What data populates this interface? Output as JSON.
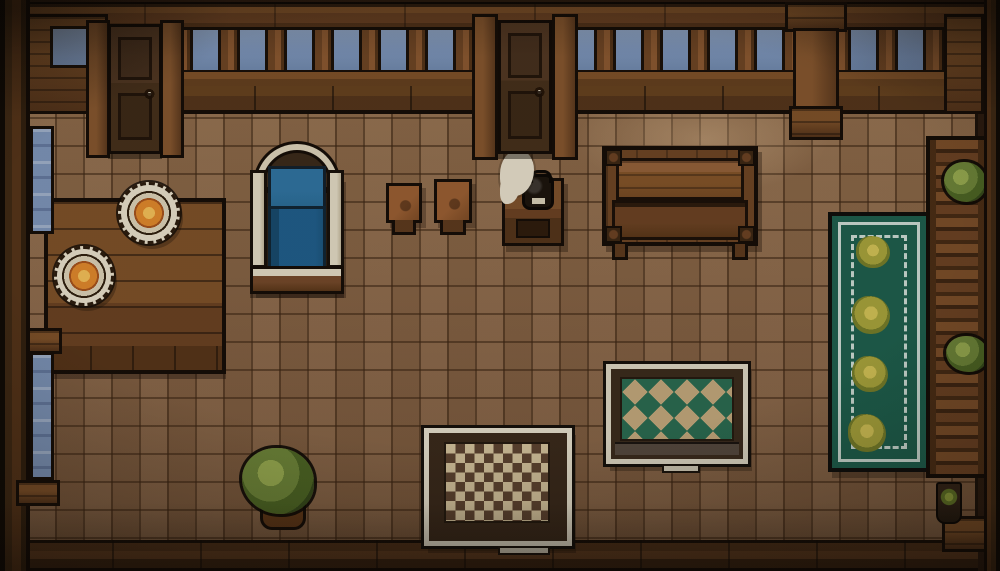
{
  "scene": {
    "description": "Top-down pixel-art tavern room: wooden walls with balustrade and sky gaps, two doors, side windows, bed with blue blanket, dining table with two plates of food, two stools, kettle stand with steam, long wooden table, teal flower runner rug, diamond-pattern rug, checkered rug, potted plants and a right-side wooden shelf",
    "objects": [
      {
        "id": "room-frame",
        "type": "room-bg",
        "x": 0,
        "y": 0,
        "w": 1000,
        "h": 571,
        "interactable": false
      },
      {
        "id": "floor",
        "type": "floor",
        "x": 24,
        "y": 86,
        "w": 954,
        "h": 460,
        "interactable": true
      },
      {
        "id": "floor-light-patch",
        "type": "floor-light-patch",
        "x": 548,
        "y": 90,
        "w": 310,
        "h": 118,
        "interactable": false
      },
      {
        "id": "bottom-floor-strip",
        "type": "bottom-floor-strip",
        "x": 24,
        "y": 540,
        "w": 954,
        "h": 31,
        "interactable": false
      },
      {
        "id": "rug-green",
        "type": "rug-green",
        "x": 828,
        "y": 212,
        "w": 102,
        "h": 260,
        "interactable": true
      },
      {
        "id": "rug-green-flower-1",
        "type": "flower",
        "x": 856,
        "y": 236,
        "w": 34,
        "h": 32,
        "interactable": false
      },
      {
        "id": "rug-green-flower-2",
        "type": "flower",
        "x": 852,
        "y": 296,
        "w": 38,
        "h": 38,
        "interactable": false
      },
      {
        "id": "rug-green-flower-3",
        "type": "flower",
        "x": 852,
        "y": 356,
        "w": 36,
        "h": 36,
        "interactable": false
      },
      {
        "id": "rug-green-flower-4",
        "type": "flower",
        "x": 848,
        "y": 414,
        "w": 38,
        "h": 38,
        "interactable": false
      },
      {
        "id": "rug-diamond",
        "type": "rug-frame-d",
        "x": 606,
        "y": 364,
        "w": 142,
        "h": 100,
        "interactable": true
      },
      {
        "id": "rug-diamond-field",
        "type": "rug-field-diamond",
        "x": 620,
        "y": 377,
        "w": 114,
        "h": 64,
        "interactable": false
      },
      {
        "id": "rug-diamond-tab",
        "type": "rug-tab",
        "x": 662,
        "y": 464,
        "w": 38,
        "h": 9,
        "interactable": false
      },
      {
        "id": "rug-checker",
        "type": "rug-frame-c",
        "x": 424,
        "y": 428,
        "w": 148,
        "h": 118,
        "interactable": true
      },
      {
        "id": "rug-checker-field",
        "type": "rug-field-checker",
        "x": 444,
        "y": 442,
        "w": 106,
        "h": 81,
        "interactable": false
      },
      {
        "id": "rug-checker-tab",
        "type": "rug-tab",
        "x": 498,
        "y": 546,
        "w": 52,
        "h": 9,
        "interactable": false
      },
      {
        "id": "dining-table",
        "type": "table-left",
        "x": 44,
        "y": 198,
        "w": 182,
        "h": 152,
        "interactable": true
      },
      {
        "id": "plate-large",
        "type": "plate",
        "x": 118,
        "y": 182,
        "w": 62,
        "h": 62,
        "interactable": true
      },
      {
        "id": "plate-small",
        "type": "plate",
        "x": 54,
        "y": 246,
        "w": 60,
        "h": 60,
        "interactable": true
      },
      {
        "id": "wall-bracket-left",
        "type": "wood-block",
        "x": 16,
        "y": 328,
        "w": 46,
        "h": 26,
        "interactable": false
      },
      {
        "id": "bed-frame",
        "type": "bed-body",
        "x": 252,
        "y": 176,
        "w": 90,
        "h": 116,
        "interactable": true
      },
      {
        "id": "bed-headboard-arch",
        "type": "bed-arch",
        "x": 256,
        "y": 144,
        "w": 82,
        "h": 46,
        "interactable": false
      },
      {
        "id": "bed-pillow",
        "type": "bed-mattress",
        "x": 268,
        "y": 166,
        "w": 58,
        "h": 44,
        "interactable": false
      },
      {
        "id": "bed-blanket",
        "type": "bed-blanket",
        "x": 268,
        "y": 206,
        "w": 58,
        "h": 66,
        "interactable": false
      },
      {
        "id": "bed-rail-left",
        "type": "bed-rail",
        "x": 250,
        "y": 170,
        "w": 17,
        "h": 98,
        "interactable": false
      },
      {
        "id": "bed-rail-right",
        "type": "bed-rail",
        "x": 327,
        "y": 170,
        "w": 17,
        "h": 98,
        "interactable": false
      },
      {
        "id": "bed-footboard",
        "type": "bed-foot",
        "x": 250,
        "y": 266,
        "w": 94,
        "h": 28,
        "interactable": false
      },
      {
        "id": "stool-1",
        "type": "stool",
        "x": 386,
        "y": 183,
        "w": 36,
        "h": 40,
        "interactable": true
      },
      {
        "id": "stool-2",
        "type": "stool",
        "x": 434,
        "y": 179,
        "w": 38,
        "h": 44,
        "interactable": true
      },
      {
        "id": "kettle-stand",
        "type": "stand",
        "x": 502,
        "y": 178,
        "w": 62,
        "h": 68,
        "interactable": true
      },
      {
        "id": "kettle",
        "type": "kettle",
        "x": 522,
        "y": 174,
        "w": 32,
        "h": 36,
        "interactable": true
      },
      {
        "id": "steam-puff",
        "type": "steam",
        "x": 500,
        "y": 150,
        "w": 34,
        "h": 46,
        "interactable": false
      },
      {
        "id": "long-table",
        "type": "lt-frame",
        "x": 602,
        "y": 146,
        "w": 156,
        "h": 100,
        "interactable": true
      },
      {
        "id": "long-table-top",
        "type": "lt-top",
        "x": 616,
        "y": 158,
        "w": 128,
        "h": 42,
        "interactable": false
      },
      {
        "id": "long-table-shelf",
        "type": "lt-shelf",
        "x": 612,
        "y": 200,
        "w": 136,
        "h": 40,
        "interactable": false
      },
      {
        "id": "long-table-corner-tl",
        "type": "lt-corner",
        "x": 605,
        "y": 149,
        "w": 17,
        "h": 17,
        "interactable": false
      },
      {
        "id": "long-table-corner-tr",
        "type": "lt-corner",
        "x": 738,
        "y": 149,
        "w": 17,
        "h": 17,
        "interactable": false
      },
      {
        "id": "long-table-corner-bl",
        "type": "lt-corner",
        "x": 605,
        "y": 226,
        "w": 17,
        "h": 17,
        "interactable": false
      },
      {
        "id": "long-table-corner-br",
        "type": "lt-corner",
        "x": 738,
        "y": 226,
        "w": 17,
        "h": 17,
        "interactable": false
      },
      {
        "id": "long-table-leg-left",
        "type": "lt-leg",
        "x": 612,
        "y": 244,
        "w": 16,
        "h": 16,
        "interactable": false
      },
      {
        "id": "long-table-leg-right",
        "type": "lt-leg",
        "x": 732,
        "y": 244,
        "w": 16,
        "h": 16,
        "interactable": false
      },
      {
        "id": "plant-shadow",
        "type": "shadow-blob",
        "x": 248,
        "y": 512,
        "w": 66,
        "h": 22,
        "interactable": false
      },
      {
        "id": "plant-pot",
        "type": "pot",
        "x": 260,
        "y": 494,
        "w": 46,
        "h": 36,
        "interactable": true
      },
      {
        "id": "plant-bush",
        "type": "bush",
        "x": 242,
        "y": 448,
        "w": 72,
        "h": 66,
        "interactable": true
      },
      {
        "id": "sky-band",
        "type": "sky",
        "x": 24,
        "y": 24,
        "w": 952,
        "h": 48,
        "interactable": false
      },
      {
        "id": "balustrade",
        "type": "balusters",
        "x": 24,
        "y": 22,
        "w": 952,
        "h": 54,
        "interactable": false
      },
      {
        "id": "top-beam",
        "type": "beam-top",
        "x": 14,
        "y": 2,
        "w": 972,
        "h": 28,
        "interactable": false
      },
      {
        "id": "balustrade-rail",
        "type": "beam-rail",
        "x": 20,
        "y": 70,
        "w": 960,
        "h": 18,
        "interactable": false
      },
      {
        "id": "wall-plank-row",
        "type": "wall-planks",
        "x": 20,
        "y": 86,
        "w": 960,
        "h": 28,
        "interactable": false
      },
      {
        "id": "wall-corner-left",
        "type": "wood-block",
        "x": 18,
        "y": 14,
        "w": 90,
        "h": 100,
        "interactable": false
      },
      {
        "id": "window-top-left",
        "type": "window-sky",
        "x": 50,
        "y": 26,
        "w": 42,
        "h": 42,
        "interactable": false
      },
      {
        "id": "wall-corner-right",
        "type": "wood-block",
        "x": 944,
        "y": 14,
        "w": 40,
        "h": 100,
        "interactable": false
      },
      {
        "id": "door-1-post-left",
        "type": "door-post",
        "x": 86,
        "y": 20,
        "w": 24,
        "h": 138,
        "interactable": false
      },
      {
        "id": "door-1-post-right",
        "type": "door-post",
        "x": 160,
        "y": 20,
        "w": 24,
        "h": 138,
        "interactable": false
      },
      {
        "id": "door-1",
        "type": "door",
        "x": 108,
        "y": 24,
        "w": 54,
        "h": 130,
        "interactable": true
      },
      {
        "id": "door-2-post-left",
        "type": "door-post",
        "x": 472,
        "y": 14,
        "w": 26,
        "h": 146,
        "interactable": false
      },
      {
        "id": "door-2-post-right",
        "type": "door-post",
        "x": 552,
        "y": 14,
        "w": 26,
        "h": 146,
        "interactable": false
      },
      {
        "id": "door-2",
        "type": "door",
        "x": 498,
        "y": 20,
        "w": 54,
        "h": 134,
        "interactable": true
      },
      {
        "id": "center-post-cap",
        "type": "wood-block",
        "x": 785,
        "y": 2,
        "w": 62,
        "h": 30,
        "interactable": false
      },
      {
        "id": "center-post",
        "type": "post",
        "x": 793,
        "y": 28,
        "w": 46,
        "h": 82,
        "interactable": false
      },
      {
        "id": "center-post-foot",
        "type": "wood-block",
        "x": 789,
        "y": 106,
        "w": 54,
        "h": 34,
        "interactable": false
      },
      {
        "id": "left-wall",
        "type": "wall-left",
        "x": 0,
        "y": 0,
        "w": 30,
        "h": 571,
        "interactable": false
      },
      {
        "id": "window-left-upper",
        "type": "window-v",
        "x": 30,
        "y": 126,
        "w": 24,
        "h": 108,
        "interactable": false
      },
      {
        "id": "window-left-lower",
        "type": "window-v",
        "x": 30,
        "y": 352,
        "w": 24,
        "h": 128,
        "interactable": false
      },
      {
        "id": "window-sill-left",
        "type": "wood-block",
        "x": 16,
        "y": 480,
        "w": 44,
        "h": 26,
        "interactable": false
      },
      {
        "id": "right-shelf",
        "type": "shelf",
        "x": 926,
        "y": 136,
        "w": 62,
        "h": 342,
        "interactable": true
      },
      {
        "id": "shelf-plant-top",
        "type": "bush",
        "x": 944,
        "y": 162,
        "w": 42,
        "h": 40,
        "interactable": false
      },
      {
        "id": "shelf-plant-mid",
        "type": "bush",
        "x": 946,
        "y": 336,
        "w": 42,
        "h": 36,
        "interactable": false
      },
      {
        "id": "corner-block-bottom-right",
        "type": "wood-block",
        "x": 942,
        "y": 516,
        "w": 46,
        "h": 36,
        "interactable": false
      },
      {
        "id": "small-pot",
        "type": "pot-small",
        "x": 936,
        "y": 482,
        "w": 26,
        "h": 42,
        "interactable": true
      },
      {
        "id": "small-pot-sprout",
        "type": "sprout",
        "x": 938,
        "y": 488,
        "w": 22,
        "h": 18,
        "interactable": false
      },
      {
        "id": "right-wall",
        "type": "wall-right",
        "x": 984,
        "y": 0,
        "w": 16,
        "h": 571,
        "interactable": false
      },
      {
        "id": "vignette",
        "type": "vignette",
        "x": 0,
        "y": 0,
        "w": 1000,
        "h": 571,
        "interactable": false
      }
    ]
  },
  "palette": {
    "outline": "#150d07",
    "wood_dark": "#53331a",
    "wood_mid": "#6b4223",
    "wood_light": "#7e5129",
    "wood_highlight": "#93613a",
    "sky_blue": "#7d96bc",
    "floor_base": "#8a6647",
    "window_blue": "#7d95ba",
    "door_wood": "#46301b",
    "bed_blue_light": "#2f74a2",
    "bed_blue_deep": "#1f5e8c",
    "cream": "#e4dcc6",
    "food_orange": "#e2892c",
    "food_core": "#f6c159",
    "rug_teal": "#1d5f4d",
    "rug_border_light": "#ccdcd4",
    "flower_olive": "#a8a43c",
    "rug_tan": "#c2a87c",
    "diamond_green": "#2a6b51",
    "checker_cream": "#d3c29c",
    "checker_brown": "#5c4330",
    "bush_green": "#6d8539",
    "bush_dark": "#35491b",
    "kettle_black": "#1b140d",
    "steam_white": "#e8e0cd"
  }
}
